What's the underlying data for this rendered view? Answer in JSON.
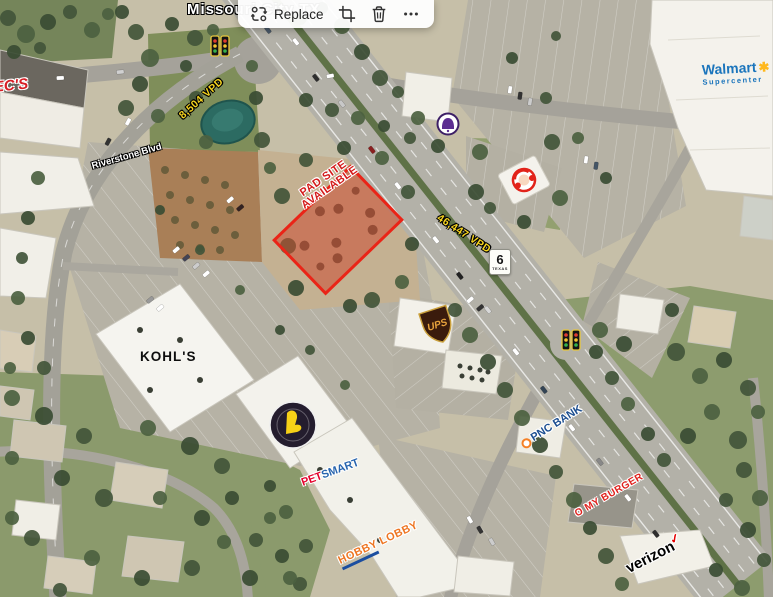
{
  "toolbar": {
    "replace_label": "Replace",
    "icons": {
      "replace": "swap-arrows-icon",
      "crop": "crop-icon",
      "delete": "trash-icon",
      "more": "ellipsis-icon"
    }
  },
  "map": {
    "city_label": "Missouri City TX",
    "pad_site": {
      "line1": "PAD SITE",
      "line2": "AVAILABLE"
    },
    "traffic_counts": {
      "highway6": "46,447 VPD",
      "riverstone": "8,504 VPD"
    },
    "streets": {
      "riverstone": "Riverstone Blvd"
    },
    "highway_shield": {
      "number": "6",
      "state": "TEXAS"
    },
    "businesses": {
      "specs": "SPEC'S",
      "walmart": "Walmart",
      "walmart_sub": "Supercenter",
      "walmart_spark": "✱",
      "kohls": "KOHL'S",
      "ups": "UPS",
      "petsmart_pet": "PET",
      "petsmart_smart": "SMART",
      "hobby_lobby": "HOBBY LOBBY",
      "pnc": "PNC BANK",
      "o_my_burger": "O MY BURGER",
      "verizon": "verizon",
      "verizon_check": "✓"
    },
    "colors": {
      "pad_site_border": "#ea2417",
      "pad_site_fill": "rgba(205,62,38,0.48)",
      "pad_site_text": "#d41a1a",
      "vpd_text": "#f6d41e",
      "walmart_blue": "#1b75bc",
      "walmart_yellow": "#ffb81c",
      "pnc_blue": "#1d4f91",
      "pnc_orange": "#f58025",
      "hobby_orange": "#ee7623",
      "petsmart_red": "#e4002b",
      "petsmart_blue": "#2764ae",
      "verizon_red": "#e60000"
    }
  }
}
